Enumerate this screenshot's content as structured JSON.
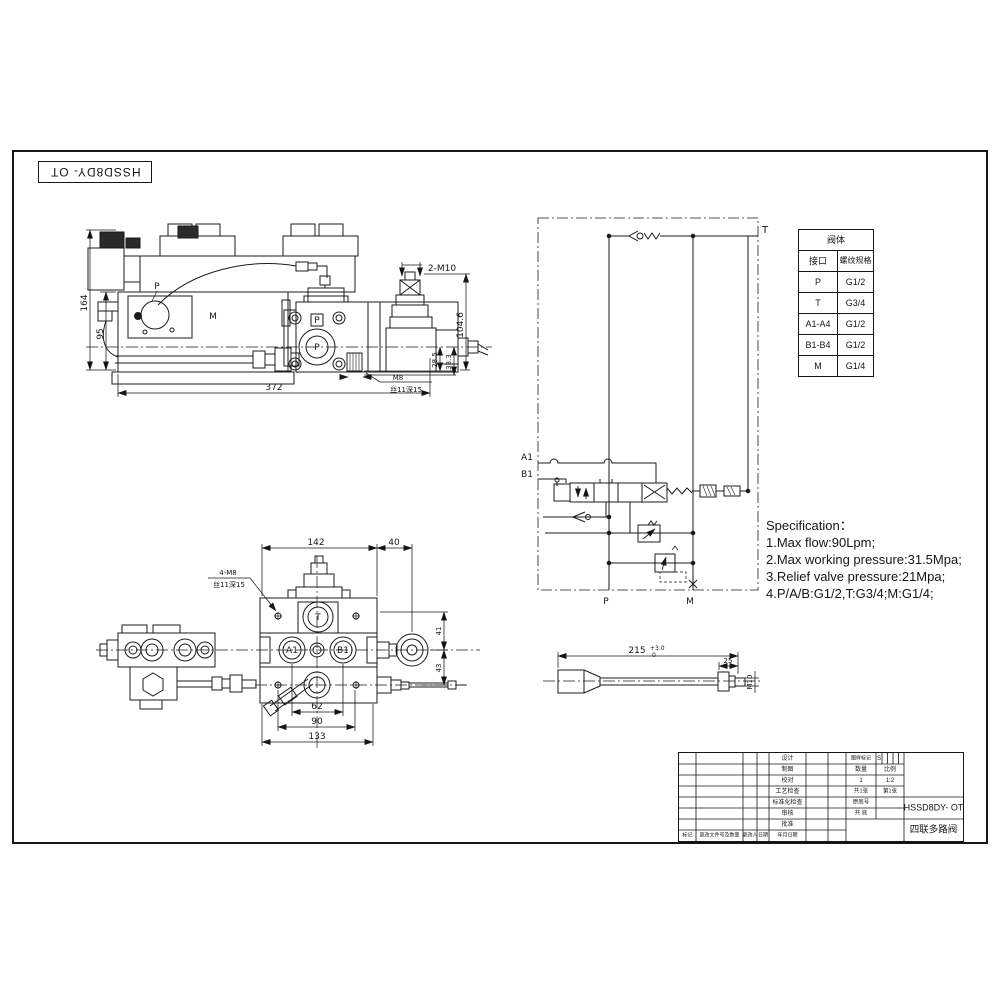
{
  "sheet": {
    "code": "HSSD8DY- OT"
  },
  "view_side": {
    "dim_164": "164",
    "dim_95": "95",
    "dim_372": "372",
    "dim_104_6": "104.6",
    "dim_28_5": "28.5",
    "dim_33_3": "33.3",
    "label_2m10": "2-M10",
    "label_m8": "M8",
    "label_m8_note": "丝11深15",
    "port_p": "P",
    "port_p_center": "P",
    "port_p_square": "P",
    "port_m": "M"
  },
  "schematic": {
    "port_t": "T",
    "port_a1": "A1",
    "port_b1": "B1",
    "port_p": "P",
    "port_m": "M"
  },
  "thread_table": {
    "title": "阀体",
    "col_port": "接口",
    "col_spec": "螺纹规格",
    "rows": [
      [
        "P",
        "G1/2"
      ],
      [
        "T",
        "G3/4"
      ],
      [
        "A1-A4",
        "G1/2"
      ],
      [
        "B1-B4",
        "G1/2"
      ],
      [
        "M",
        "G1/4"
      ]
    ]
  },
  "specification": {
    "title": "Specification：",
    "line1": "1.Max flow:90Lpm;",
    "line2": "2.Max working pressure:31.5Mpa;",
    "line3": "3.Relief valve pressure:21Mpa;",
    "line4": "4.P/A/B:G1/2,T:G3/4;M:G1/4;"
  },
  "view_top": {
    "dim_142": "142",
    "dim_40": "40",
    "dim_41": "41",
    "dim_43": "43",
    "dim_62": "62",
    "dim_90": "90",
    "dim_133": "133",
    "label_4m8": "4-M8",
    "label_4m8_note": "丝11深15",
    "port_t": "T",
    "port_a1": "A1",
    "port_b1": "B1"
  },
  "lever": {
    "dim_215": "215",
    "tol_upper": "+3.0",
    "tol_lower": "0",
    "dim_25": "25",
    "label_m10": "M10"
  },
  "title_block": {
    "row_labels": [
      "设计",
      "制图",
      "校对",
      "工艺检查",
      "标准化检查",
      "审核",
      "批准"
    ],
    "bottom_labels": [
      "标记",
      "更改文件号及数量",
      "更改人",
      "日期",
      "年月日期"
    ],
    "stage_label": "图样标记",
    "stage_value": "S",
    "qty_label": "数量",
    "scale_label": "比例",
    "qty_value": "1",
    "scale_value": "1:2",
    "sheets_total": "共1张",
    "sheet_index": "第1张",
    "orig_label": "原底号",
    "archive_label": "共 底",
    "part_no": "HSSD8DY- OT",
    "part_name": "四联多路阀"
  }
}
